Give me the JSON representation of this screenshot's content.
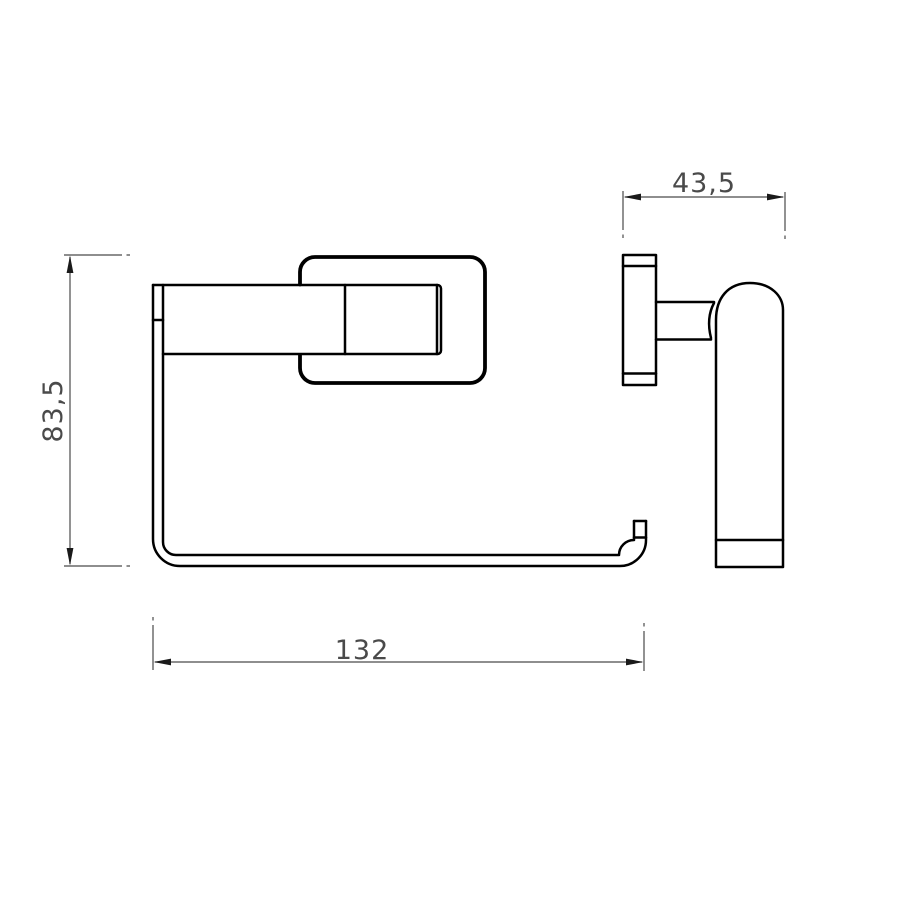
{
  "drawing": {
    "background": "#ffffff",
    "line_color": "#000000",
    "plate_outline_color": "#000000",
    "dimension_color": "#4a4a4a",
    "arrow_color": "#1a1a1a",
    "dimensions": {
      "height": "83,5",
      "depth": "43,5",
      "width": "132"
    }
  }
}
